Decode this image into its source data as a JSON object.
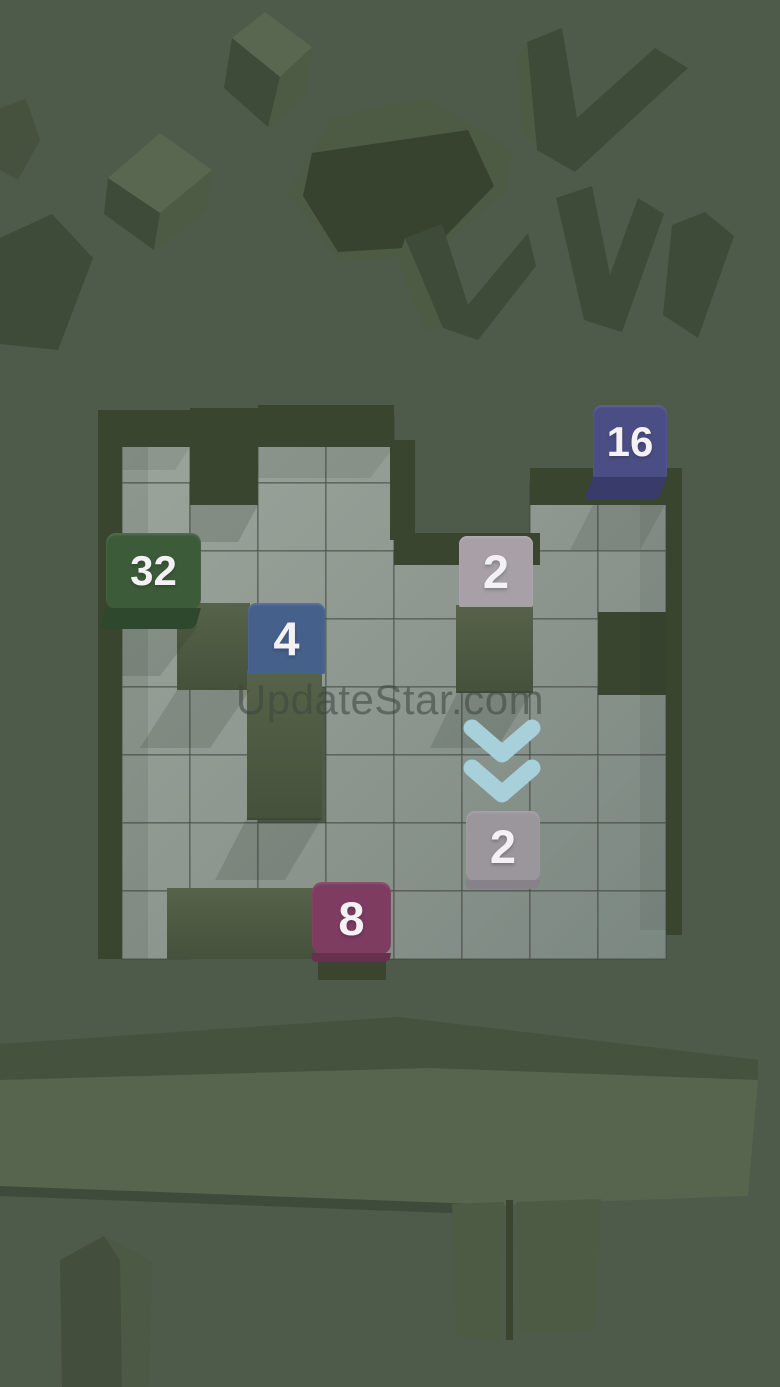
{
  "app": {
    "watermark": "UpdateStar.com"
  },
  "palette": {
    "background": "#4e5a4a",
    "floor_light": "#9ba59b",
    "floor_dark": "#7b8781",
    "grid_line": "#3a423a",
    "wall_dark": "#39452f",
    "pillar_top": "#57624a",
    "pillar_bottom": "#45513b",
    "decor_dark": "#3f4b39",
    "decor_mid": "#4d5a44",
    "decor_light": "#5a6750",
    "box_interior": "#37422f"
  },
  "board": {
    "origin_x": 122,
    "origin_y": 415,
    "cell": 68,
    "cols": 8,
    "rows": 8,
    "cells": [
      "10110000",
      "11110011",
      "11111011",
      "10111010",
      "11011111",
      "11011111",
      "11111111",
      "10011111"
    ],
    "walls": [
      {
        "x": 98,
        "y": 410,
        "w": 24,
        "h": 549,
        "type": "wall"
      },
      {
        "x": 98,
        "y": 410,
        "w": 92,
        "h": 37,
        "type": "wall"
      },
      {
        "x": 190,
        "y": 408,
        "w": 68,
        "h": 97,
        "type": "wall"
      },
      {
        "x": 258,
        "y": 405,
        "w": 136,
        "h": 42,
        "type": "wall"
      },
      {
        "x": 390,
        "y": 440,
        "w": 25,
        "h": 100,
        "type": "wall"
      },
      {
        "x": 394,
        "y": 533,
        "w": 146,
        "h": 32,
        "type": "wall"
      },
      {
        "x": 530,
        "y": 468,
        "w": 152,
        "h": 37,
        "type": "wall"
      },
      {
        "x": 666,
        "y": 505,
        "w": 16,
        "h": 430,
        "type": "wall"
      },
      {
        "x": 598,
        "y": 612,
        "w": 84,
        "h": 83,
        "type": "wall"
      },
      {
        "x": 167,
        "y": 888,
        "w": 155,
        "h": 71,
        "type": "pillar"
      },
      {
        "x": 318,
        "y": 958,
        "w": 68,
        "h": 22,
        "type": "wall"
      }
    ],
    "obstacles": [
      {
        "x": 177,
        "y": 603,
        "w": 73,
        "h": 87
      },
      {
        "x": 247,
        "y": 670,
        "w": 75,
        "h": 150
      },
      {
        "x": 456,
        "y": 605,
        "w": 77,
        "h": 88
      }
    ]
  },
  "tiles": [
    {
      "value": "16",
      "x": 593,
      "y": 405,
      "w": 74,
      "face_h": 73,
      "bottom_h": 23,
      "face": "#4b4e84",
      "edge": "#393c6b",
      "radius": "9px 9px 3px 3px",
      "skew": -22
    },
    {
      "value": "32",
      "x": 106,
      "y": 533,
      "w": 95,
      "face_h": 76,
      "bottom_h": 21,
      "face": "#3c5b39",
      "edge": "#2d482c",
      "radius": "10px",
      "skew": -16
    },
    {
      "value": "4",
      "x": 248,
      "y": 603,
      "w": 77,
      "face_h": 71,
      "bottom_h": 0,
      "face": "#46608c",
      "edge": "#38507a",
      "radius": "8px 8px 2px 2px",
      "skew": 0
    },
    {
      "value": "2",
      "x": 459,
      "y": 536,
      "w": 74,
      "face_h": 71,
      "bottom_h": 0,
      "face": "#a7a1a7",
      "edge": "#918c93",
      "radius": "8px 8px 2px 2px",
      "skew": 0
    },
    {
      "value": "2",
      "x": 466,
      "y": 811,
      "w": 74,
      "face_h": 70,
      "bottom_h": 9,
      "face": "#9b959c",
      "edge": "#878189",
      "radius": "9px",
      "skew": -6
    },
    {
      "value": "8",
      "x": 312,
      "y": 882,
      "w": 79,
      "face_h": 72,
      "bottom_h": 9,
      "face": "#7e3c60",
      "edge": "#66304e",
      "radius": "10px",
      "skew": -8
    }
  ],
  "hint": {
    "icon": "chevron-double-down-icon",
    "color": "#a8d0da"
  }
}
